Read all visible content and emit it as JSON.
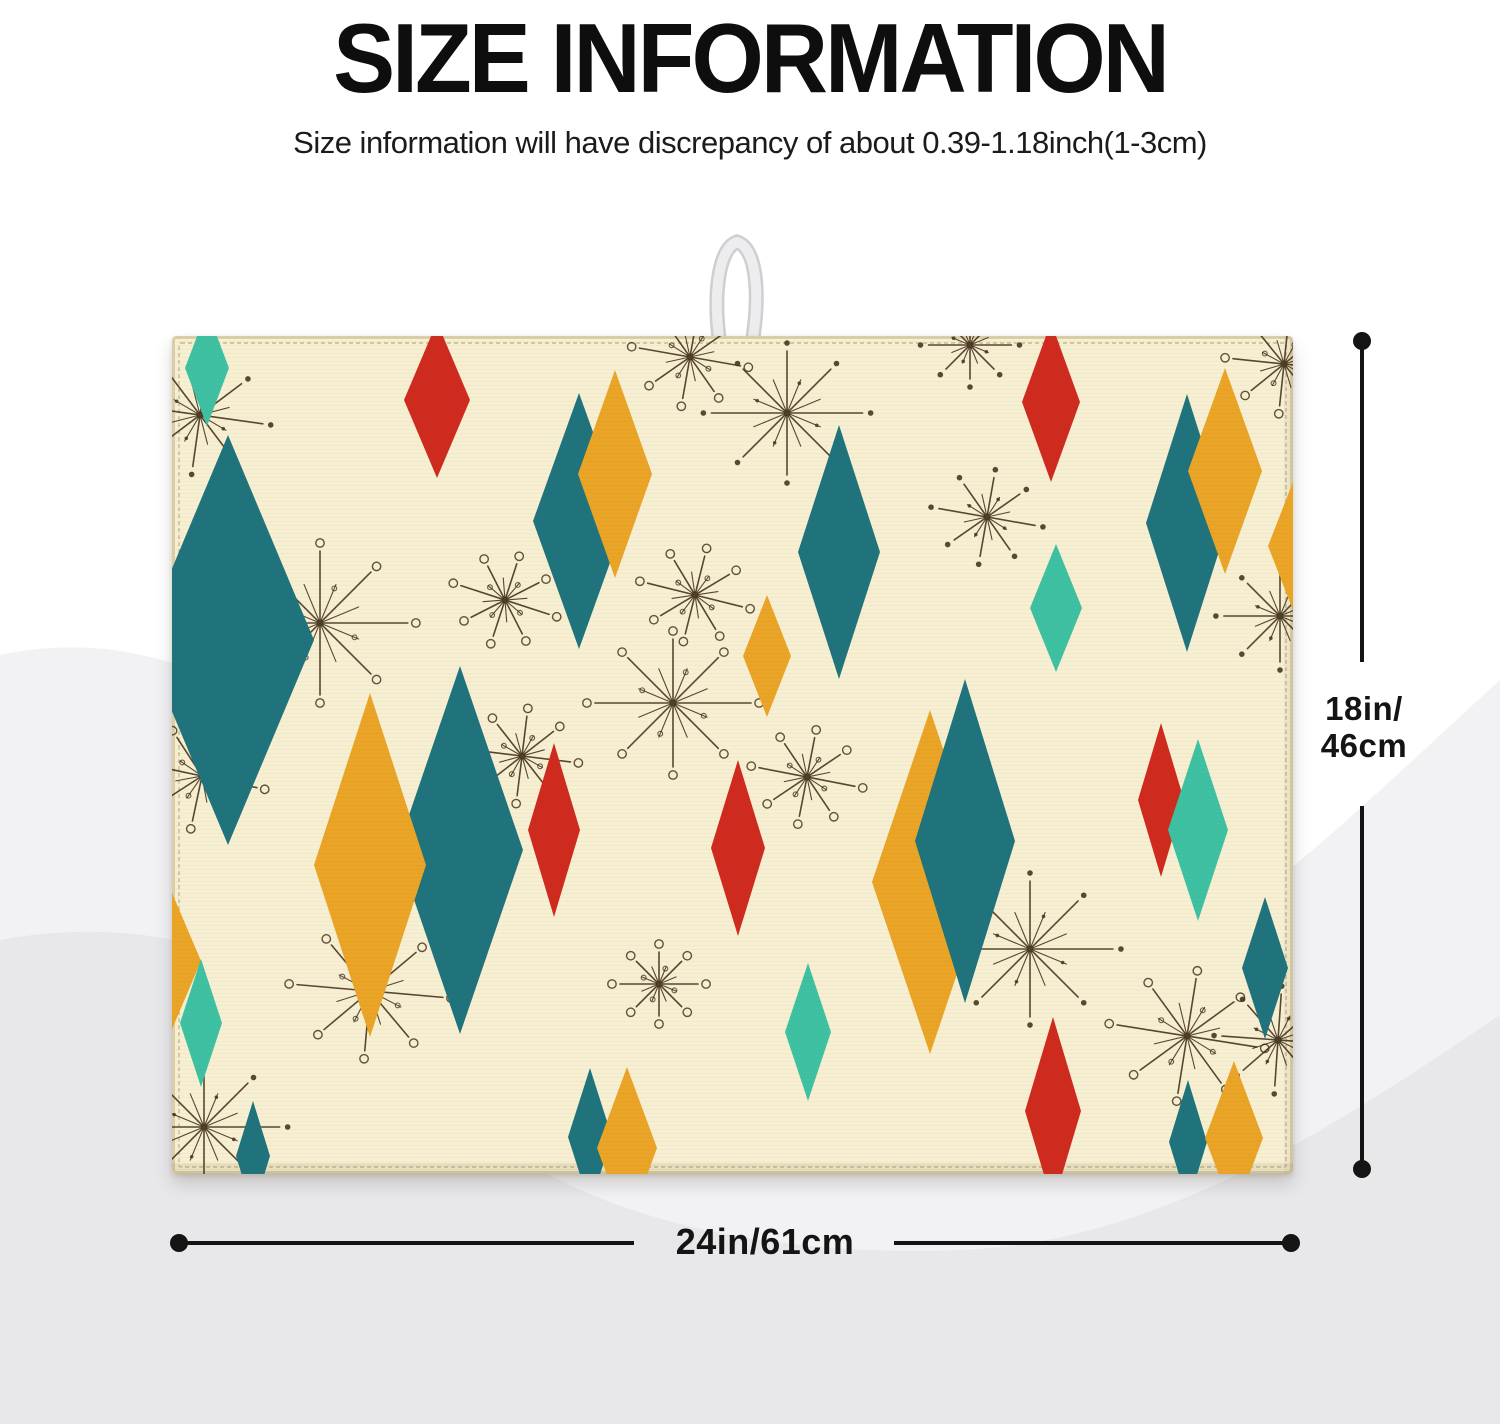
{
  "header": {
    "title": "SIZE INFORMATION",
    "subtitle": "Size information will have discrepancy of about 0.39-1.18inch(1-3cm)"
  },
  "dimensions": {
    "height_label_line1": "18in/",
    "height_label_line2": "46cm",
    "width_label": "24in/61cm"
  },
  "product": {
    "name": "dish drying mat with atomic diamond pattern and hanging loop",
    "colors": {
      "mat_bg": "#f7efd2",
      "teal": "#1f737c",
      "turquoise": "#3ec1a2",
      "gold": "#eaa426",
      "red": "#cf2a1e",
      "starburst": "#46341f",
      "stitch": "#bcb08a",
      "edge": "#d9cfa9",
      "loop": "#e2e2e4",
      "dimension": "#141414",
      "wave_light": "#f2f2f5",
      "wave_dark": "#e8e8eb"
    },
    "pattern": {
      "diamonds": [
        {
          "x": 35,
          "y": 32,
          "hw": 22,
          "hh": 58,
          "color": "turquoise"
        },
        {
          "x": 56,
          "y": 304,
          "hw": 86,
          "hh": 205,
          "color": "teal"
        },
        {
          "x": -5,
          "y": 625,
          "hw": 34,
          "hh": 80,
          "color": "gold"
        },
        {
          "x": 29,
          "y": 687,
          "hw": 21,
          "hh": 64,
          "color": "turquoise"
        },
        {
          "x": 81,
          "y": 820,
          "hw": 17,
          "hh": 55,
          "color": "teal"
        },
        {
          "x": 288,
          "y": 514,
          "hw": 63,
          "hh": 184,
          "color": "teal"
        },
        {
          "x": 198,
          "y": 529,
          "hw": 56,
          "hh": 172,
          "color": "gold"
        },
        {
          "x": 265,
          "y": 64,
          "hw": 33,
          "hh": 78,
          "color": "red"
        },
        {
          "x": 407,
          "y": 185,
          "hw": 46,
          "hh": 128,
          "color": "teal"
        },
        {
          "x": 443,
          "y": 138,
          "hw": 37,
          "hh": 104,
          "color": "gold"
        },
        {
          "x": 667,
          "y": 216,
          "hw": 41,
          "hh": 127,
          "color": "teal"
        },
        {
          "x": 595,
          "y": 320,
          "hw": 24,
          "hh": 61,
          "color": "gold"
        },
        {
          "x": 566,
          "y": 512,
          "hw": 27,
          "hh": 88,
          "color": "red"
        },
        {
          "x": 382,
          "y": 494,
          "hw": 26,
          "hh": 87,
          "color": "red"
        },
        {
          "x": 636,
          "y": 696,
          "hw": 23,
          "hh": 69,
          "color": "turquoise"
        },
        {
          "x": 879,
          "y": 66,
          "hw": 29,
          "hh": 80,
          "color": "red"
        },
        {
          "x": 884,
          "y": 272,
          "hw": 26,
          "hh": 64,
          "color": "turquoise"
        },
        {
          "x": 1015,
          "y": 187,
          "hw": 41,
          "hh": 129,
          "color": "teal"
        },
        {
          "x": 1053,
          "y": 135,
          "hw": 37,
          "hh": 103,
          "color": "gold"
        },
        {
          "x": 758,
          "y": 546,
          "hw": 58,
          "hh": 172,
          "color": "gold"
        },
        {
          "x": 793,
          "y": 505,
          "hw": 50,
          "hh": 162,
          "color": "teal"
        },
        {
          "x": 881,
          "y": 775,
          "hw": 28,
          "hh": 94,
          "color": "red"
        },
        {
          "x": 989,
          "y": 464,
          "hw": 23,
          "hh": 77,
          "color": "red"
        },
        {
          "x": 1026,
          "y": 494,
          "hw": 30,
          "hh": 91,
          "color": "turquoise"
        },
        {
          "x": 1093,
          "y": 632,
          "hw": 23,
          "hh": 71,
          "color": "teal"
        },
        {
          "x": 1016,
          "y": 806,
          "hw": 19,
          "hh": 62,
          "color": "teal"
        },
        {
          "x": 1062,
          "y": 802,
          "hw": 29,
          "hh": 77,
          "color": "gold"
        },
        {
          "x": 418,
          "y": 801,
          "hw": 22,
          "hh": 69,
          "color": "teal"
        },
        {
          "x": 455,
          "y": 812,
          "hw": 30,
          "hh": 81,
          "color": "gold"
        },
        {
          "x": 1128,
          "y": 210,
          "hw": 32,
          "hh": 82,
          "color": "gold"
        }
      ],
      "starbursts": [
        {
          "x": 28,
          "y": 79,
          "r": 52,
          "type": "dots",
          "rot": 8
        },
        {
          "x": 148,
          "y": 287,
          "r": 72,
          "type": "circles",
          "rot": 0
        },
        {
          "x": 30,
          "y": 440,
          "r": 46,
          "type": "circles",
          "rot": 12
        },
        {
          "x": 198,
          "y": 655,
          "r": 60,
          "type": "circles",
          "rot": 5
        },
        {
          "x": 32,
          "y": 791,
          "r": 62,
          "type": "dots",
          "rot": 0
        },
        {
          "x": 518,
          "y": 21,
          "r": 42,
          "type": "circles",
          "rot": 10
        },
        {
          "x": 615,
          "y": 77,
          "r": 62,
          "type": "dots",
          "rot": 0
        },
        {
          "x": 523,
          "y": 259,
          "r": 40,
          "type": "circles",
          "rot": 14
        },
        {
          "x": 501,
          "y": 367,
          "r": 64,
          "type": "circles",
          "rot": 0
        },
        {
          "x": 350,
          "y": 420,
          "r": 40,
          "type": "circles",
          "rot": 7
        },
        {
          "x": 333,
          "y": 264,
          "r": 38,
          "type": "circles",
          "rot": 18
        },
        {
          "x": 815,
          "y": 181,
          "r": 40,
          "type": "dots",
          "rot": 10
        },
        {
          "x": 798,
          "y": 9,
          "r": 34,
          "type": "dots",
          "rot": 0
        },
        {
          "x": 1112,
          "y": 28,
          "r": 42,
          "type": "circles",
          "rot": 6
        },
        {
          "x": 1108,
          "y": 280,
          "r": 46,
          "type": "dots",
          "rot": 0
        },
        {
          "x": 858,
          "y": 613,
          "r": 68,
          "type": "dots",
          "rot": 0
        },
        {
          "x": 1015,
          "y": 700,
          "r": 58,
          "type": "circles",
          "rot": 9
        },
        {
          "x": 1106,
          "y": 704,
          "r": 46,
          "type": "dots",
          "rot": 4
        },
        {
          "x": 487,
          "y": 648,
          "r": 32,
          "type": "circles",
          "rot": 0
        },
        {
          "x": 635,
          "y": 441,
          "r": 40,
          "type": "circles",
          "rot": 11
        }
      ]
    }
  }
}
